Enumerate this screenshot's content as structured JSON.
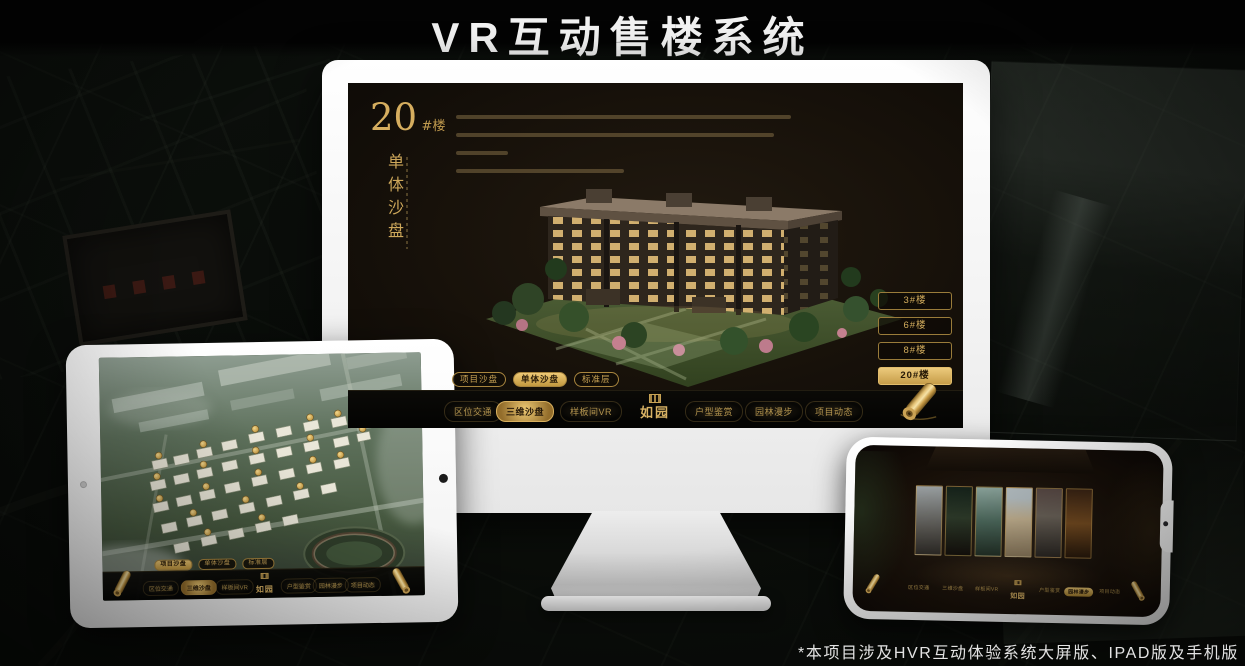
{
  "page": {
    "title": "VR互动售楼系统",
    "footnote": "*本项目涉及HVR互动体验系统大屏版、IPAD版及手机版"
  },
  "brand": {
    "name": "如园"
  },
  "colors": {
    "gold": "#C9A355",
    "gold_bright": "#EACB7A",
    "screen_bg": "#17110A",
    "page_bg": "#0A0D0A",
    "title_white": "#F2F2F2"
  },
  "icons": {
    "nav_end": "rolled-gold-scroll",
    "logo_mark": "square-seal"
  },
  "nav_menu": {
    "items": [
      "区位交通",
      "三维沙盘",
      "样板间VR",
      "户型鉴赏",
      "园林漫步",
      "项目动态"
    ],
    "active_monitor": "三维沙盘",
    "active_tablet": "三维沙盘",
    "active_phone": "园林漫步"
  },
  "sub_tabs": {
    "items": [
      "项目沙盘",
      "单体沙盘",
      "标准层"
    ],
    "active_monitor": "单体沙盘",
    "active_tablet": "项目沙盘"
  },
  "monitor": {
    "heading": {
      "number": "20",
      "unit": "#楼",
      "vertical_title": "单体沙盘"
    },
    "floor_buttons": {
      "items": [
        "3#楼",
        "6#楼",
        "8#楼",
        "20#楼"
      ],
      "active": "20#楼"
    }
  }
}
